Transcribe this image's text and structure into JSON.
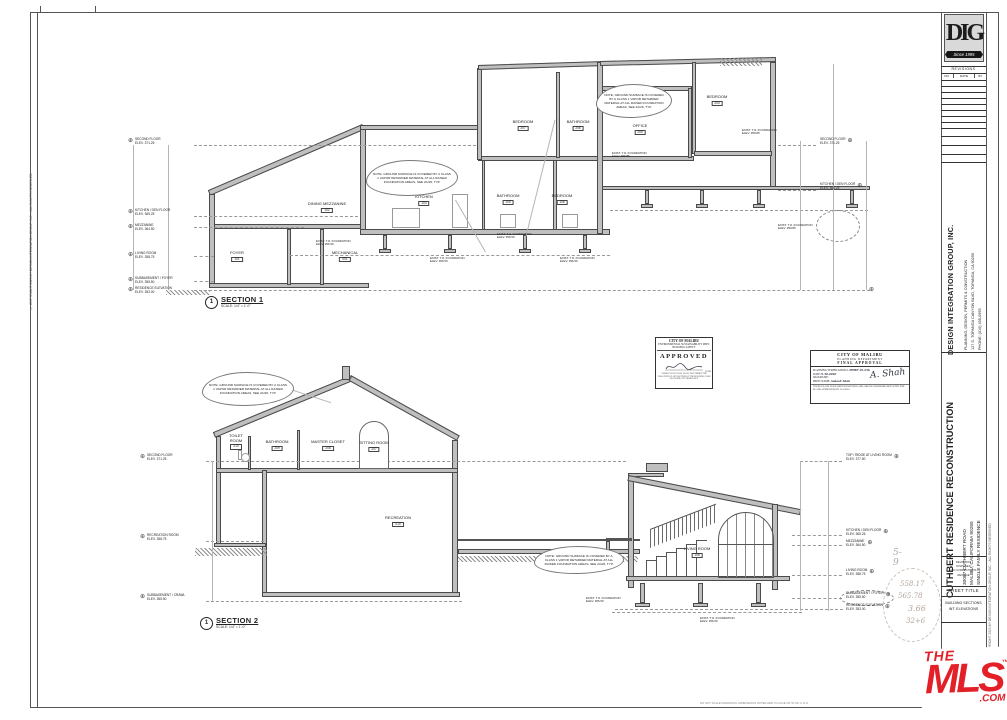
{
  "sheet": {
    "copyright_left": "© COPYRIGHT 2023 BY DESIGN INTEGRATION GROUP, INC. - ALL RIGHTS RESERVED",
    "copyright_right": "© COPYRIGHT 2023 BY DESIGN INTEGRATION GROUP, INC. - ALL RIGHTS RESERVED",
    "fine_print": "DO NOT SCALE DRAWINGS. DIMENSIONS NOTED ARE TO FACE OF STUD, U.N.O."
  },
  "titleblock": {
    "logo": {
      "monogram": "DIG",
      "tagline": "Since 1995"
    },
    "revisions": {
      "title": "REVISIONS",
      "columns": [
        "NO.",
        "DATE",
        "BY"
      ]
    },
    "firm": {
      "name": "DESIGN INTEGRATION GROUP, INC.",
      "services": "PLANNING, DESIGN, PERMITS & CONSTRUCTION",
      "address": "127 S. TOPANGA CANYON BLVD, TOPANGA, CA 90290",
      "phone": "PHONE: (310) 455-0995"
    },
    "project": {
      "title": "CUTHBERT RESIDENCE RECONSTRUCTION",
      "address1": "30087 CUTHBERT ROAD",
      "address2": "MALIBU, CALIFORNIA 90265",
      "type": "SINGLE FAMILY RESIDENCE"
    },
    "revision_note": [
      "REVISIONS",
      "DISPOSED",
      "NO CORRECTIONS",
      "REISSUE"
    ],
    "sheet_title_label": "SHEET TITLE",
    "sheet_title_lines": [
      "BUILDING SECTIONS",
      "INT. ELEVATIONS"
    ]
  },
  "mls": {
    "the": "THE",
    "name": "MLS",
    "tm": "™",
    "com": ".COM"
  },
  "shared": {
    "ground_note": "NOTE: GROUND SURFACE IS COVERED BY A CLASS 1 VAPOR RETARDER MATERIAL AT ALL RAISED FOUNDATION AREAS, SEE 2A/26, TYP.",
    "fnd_low": {
      "l1": "EXIST. T.O. FOUNDATION",
      "l2": "ELEV. 356.50"
    },
    "fnd_high": {
      "l1": "EXIST. T.O. FOUNDATION",
      "l2": "ELEV. 359.85"
    }
  },
  "section1": {
    "tag_number": "1",
    "title": "SECTION 1",
    "scale": "SCALE:   1/4\" = 1'-0\"",
    "rooms": {
      "bedroom_upper": {
        "name": "BEDROOM",
        "num": "207"
      },
      "bathroom_upper": {
        "name": "BATHROOM",
        "num": "206"
      },
      "office": {
        "name": "OFFICE",
        "num": "205"
      },
      "bedroom_right": {
        "name": "BEDROOM",
        "num": "204"
      },
      "kitchen": {
        "name": "KITCHEN",
        "num": "103"
      },
      "bathroom_mid": {
        "name": "BATHROOM",
        "num": "105"
      },
      "bedroom_mid": {
        "name": "BEDROOM",
        "num": "106"
      },
      "dining_mezzanine": {
        "name": "DINING MEZZANINE",
        "num": "102"
      },
      "mechanical": {
        "name": "MECHANICAL",
        "num": "001"
      },
      "foyer": {
        "name": "FOYER",
        "num": "101"
      }
    },
    "levels_left": [
      {
        "l1": "SECOND FLOOR",
        "l2": "ELEV. 371.25"
      },
      {
        "l1": "KITCHEN / DEN FLOOR",
        "l2": "ELEV. 365.25"
      },
      {
        "l1": "MEZZANINE",
        "l2": "ELEV. 364.50"
      },
      {
        "l1": "LIVING ROOM",
        "l2": "ELEV. 358.75"
      },
      {
        "l1": "SUBBASEMENT / FOYER",
        "l2": "ELEV. 355.50"
      },
      {
        "l1": "RESIDENCE ELEVATION",
        "l2": "ELEV. 353.00"
      }
    ],
    "levels_right": [
      {
        "l1": "SECOND FLOOR",
        "l2": "ELEV. 371.25"
      },
      {
        "l1": "KITCHEN / DEN FLOOR",
        "l2": "ELEV. 365.25"
      }
    ]
  },
  "section2": {
    "tag_number": "1",
    "title": "SECTION 2",
    "scale": "SCALE:   1/4\" = 1'-0\"",
    "rooms": {
      "toilet_room": {
        "name": "TOILET ROOM",
        "num": "210"
      },
      "bathroom": {
        "name": "BATHROOM",
        "num": "209"
      },
      "master_closet": {
        "name": "MASTER CLOSET",
        "num": "208"
      },
      "sitting_room": {
        "name": "SITTING ROOM",
        "num": "207"
      },
      "recreation": {
        "name": "RECREATION",
        "num": "010"
      },
      "living_room": {
        "name": "LIVING ROOM",
        "num": "108"
      }
    },
    "levels_left": [
      {
        "l1": "SECOND FLOOR",
        "l2": "ELEV. 371.25"
      },
      {
        "l1": "RECREATION ROOM",
        "l2": "ELEV. 358.75"
      },
      {
        "l1": "SUBBASEMENT / CRAWL",
        "l2": "ELEV. 355.50"
      }
    ],
    "levels_right": [
      {
        "l1": "TOP / RIDGE AT LIVING ROOM",
        "l2": "ELEV. 377.50"
      },
      {
        "l1": "KITCHEN / DEN FLOOR",
        "l2": "ELEV. 365.25"
      },
      {
        "l1": "MEZZANINE",
        "l2": "ELEV. 364.50"
      },
      {
        "l1": "LIVING ROOM",
        "l2": "ELEV. 358.75"
      },
      {
        "l1": "SUBBASEMENT / FOYER",
        "l2": "ELEV. 355.50"
      },
      {
        "l1": "RESIDENCE ELEVATION",
        "l2": "ELEV. 353.00"
      }
    ],
    "pencil_notes": [
      "5-9",
      "558.17",
      "565.78",
      "3.66",
      "32+6"
    ]
  },
  "stamps": {
    "building": {
      "city": "CITY OF MALIBU",
      "dept": "ENVIRONMENTAL SUSTAINABILITY DEPT.",
      "division": "BUILDING SAFETY",
      "approved": "APPROVED",
      "date_label": "DATE",
      "fine_print": "APPROVAL OF PLANS SHALL NOT PERMIT THE VIOLATION OF ANY SECTION OF THE BUILDING CODE OR OTHER CITY ORDINANCE"
    },
    "planning": {
      "city": "CITY OF MALIBU",
      "dept": "PLANNING DEPARTMENT",
      "title": "FINAL APPROVAL",
      "row1_label": "PLANNING VERIFICATION #:",
      "row1_value": "PPMP 19-236",
      "row2_label": "DATE:",
      "row2_value": "9.30.2020",
      "row3_label": "SIGNATURE:",
      "row4_label": "PRINT NAME:",
      "row4_value": "Aakash Shah",
      "signature_script": "A. Shah",
      "footer": "THESE PLANS HAVE BEEN REVIEWED AND ARE IN CONFORMANCE WITH THE PLANS APPROVED ON 11.2.2020"
    }
  }
}
